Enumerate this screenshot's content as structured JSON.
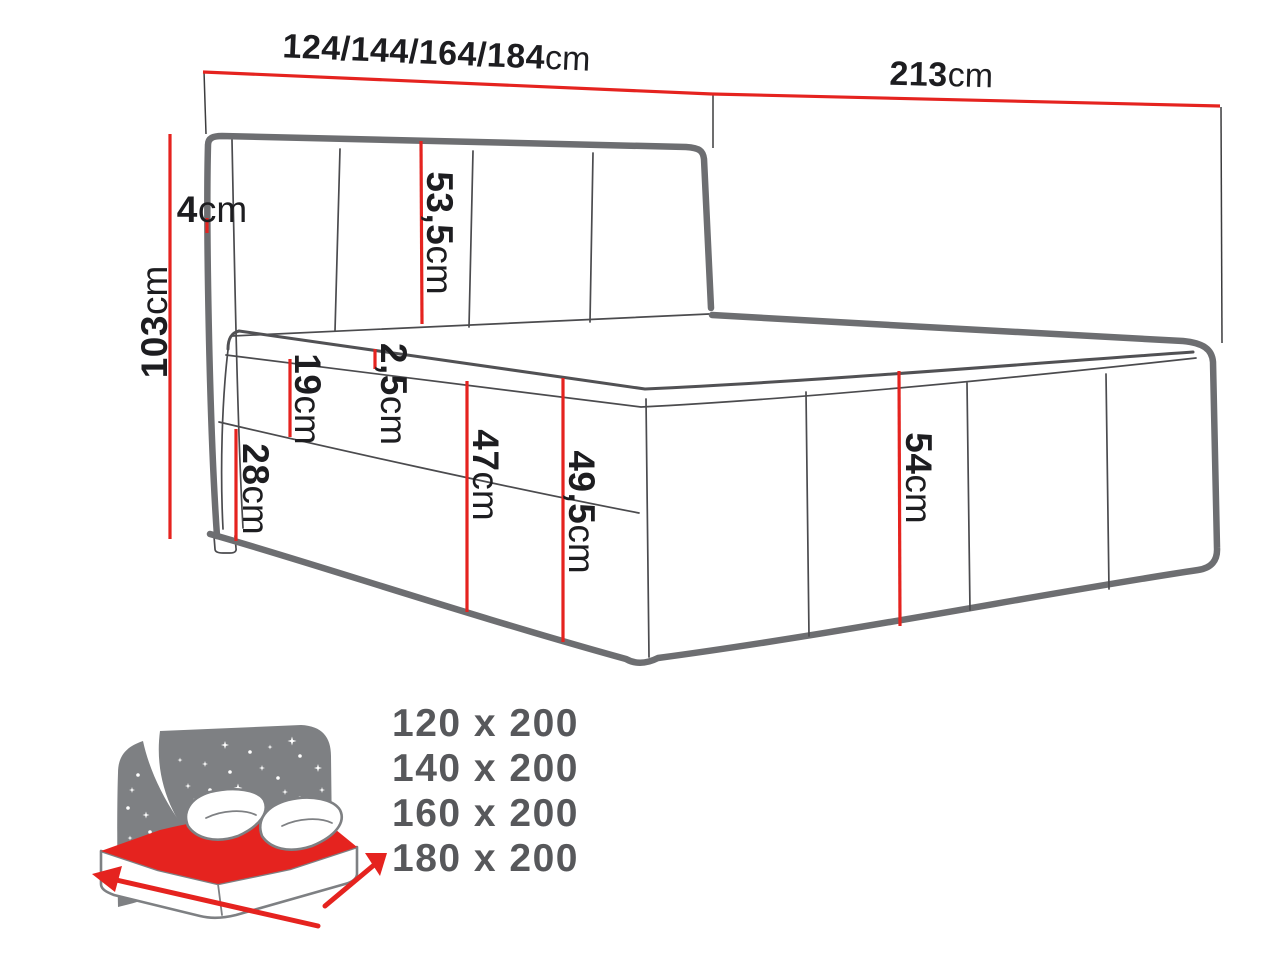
{
  "figure": {
    "unit": "cm",
    "dims": {
      "width_options": "124/144/164/184",
      "length": "213",
      "total_height": "103",
      "headboard_edge": "4",
      "headboard_panel": "53,5",
      "topper_edge": "2,5",
      "mattress_side": "19",
      "base_side": "28",
      "height_front": "47",
      "height_with_topper": "49,5",
      "side_height": "54"
    },
    "sizes": [
      "120 x 200",
      "140 x 200",
      "160 x 200",
      "180 x 200"
    ],
    "icon": "bed-with-starry-headboard-icon",
    "colors": {
      "dimension_red": "#e5231f",
      "outline_gray": "#6d6e71",
      "thin_line_gray": "#4b4b4e",
      "label_black": "#1d1d20",
      "icon_gray": "#7e8083",
      "icon_red": "#e5231f",
      "sizes_text_gray": "#57585b"
    }
  }
}
